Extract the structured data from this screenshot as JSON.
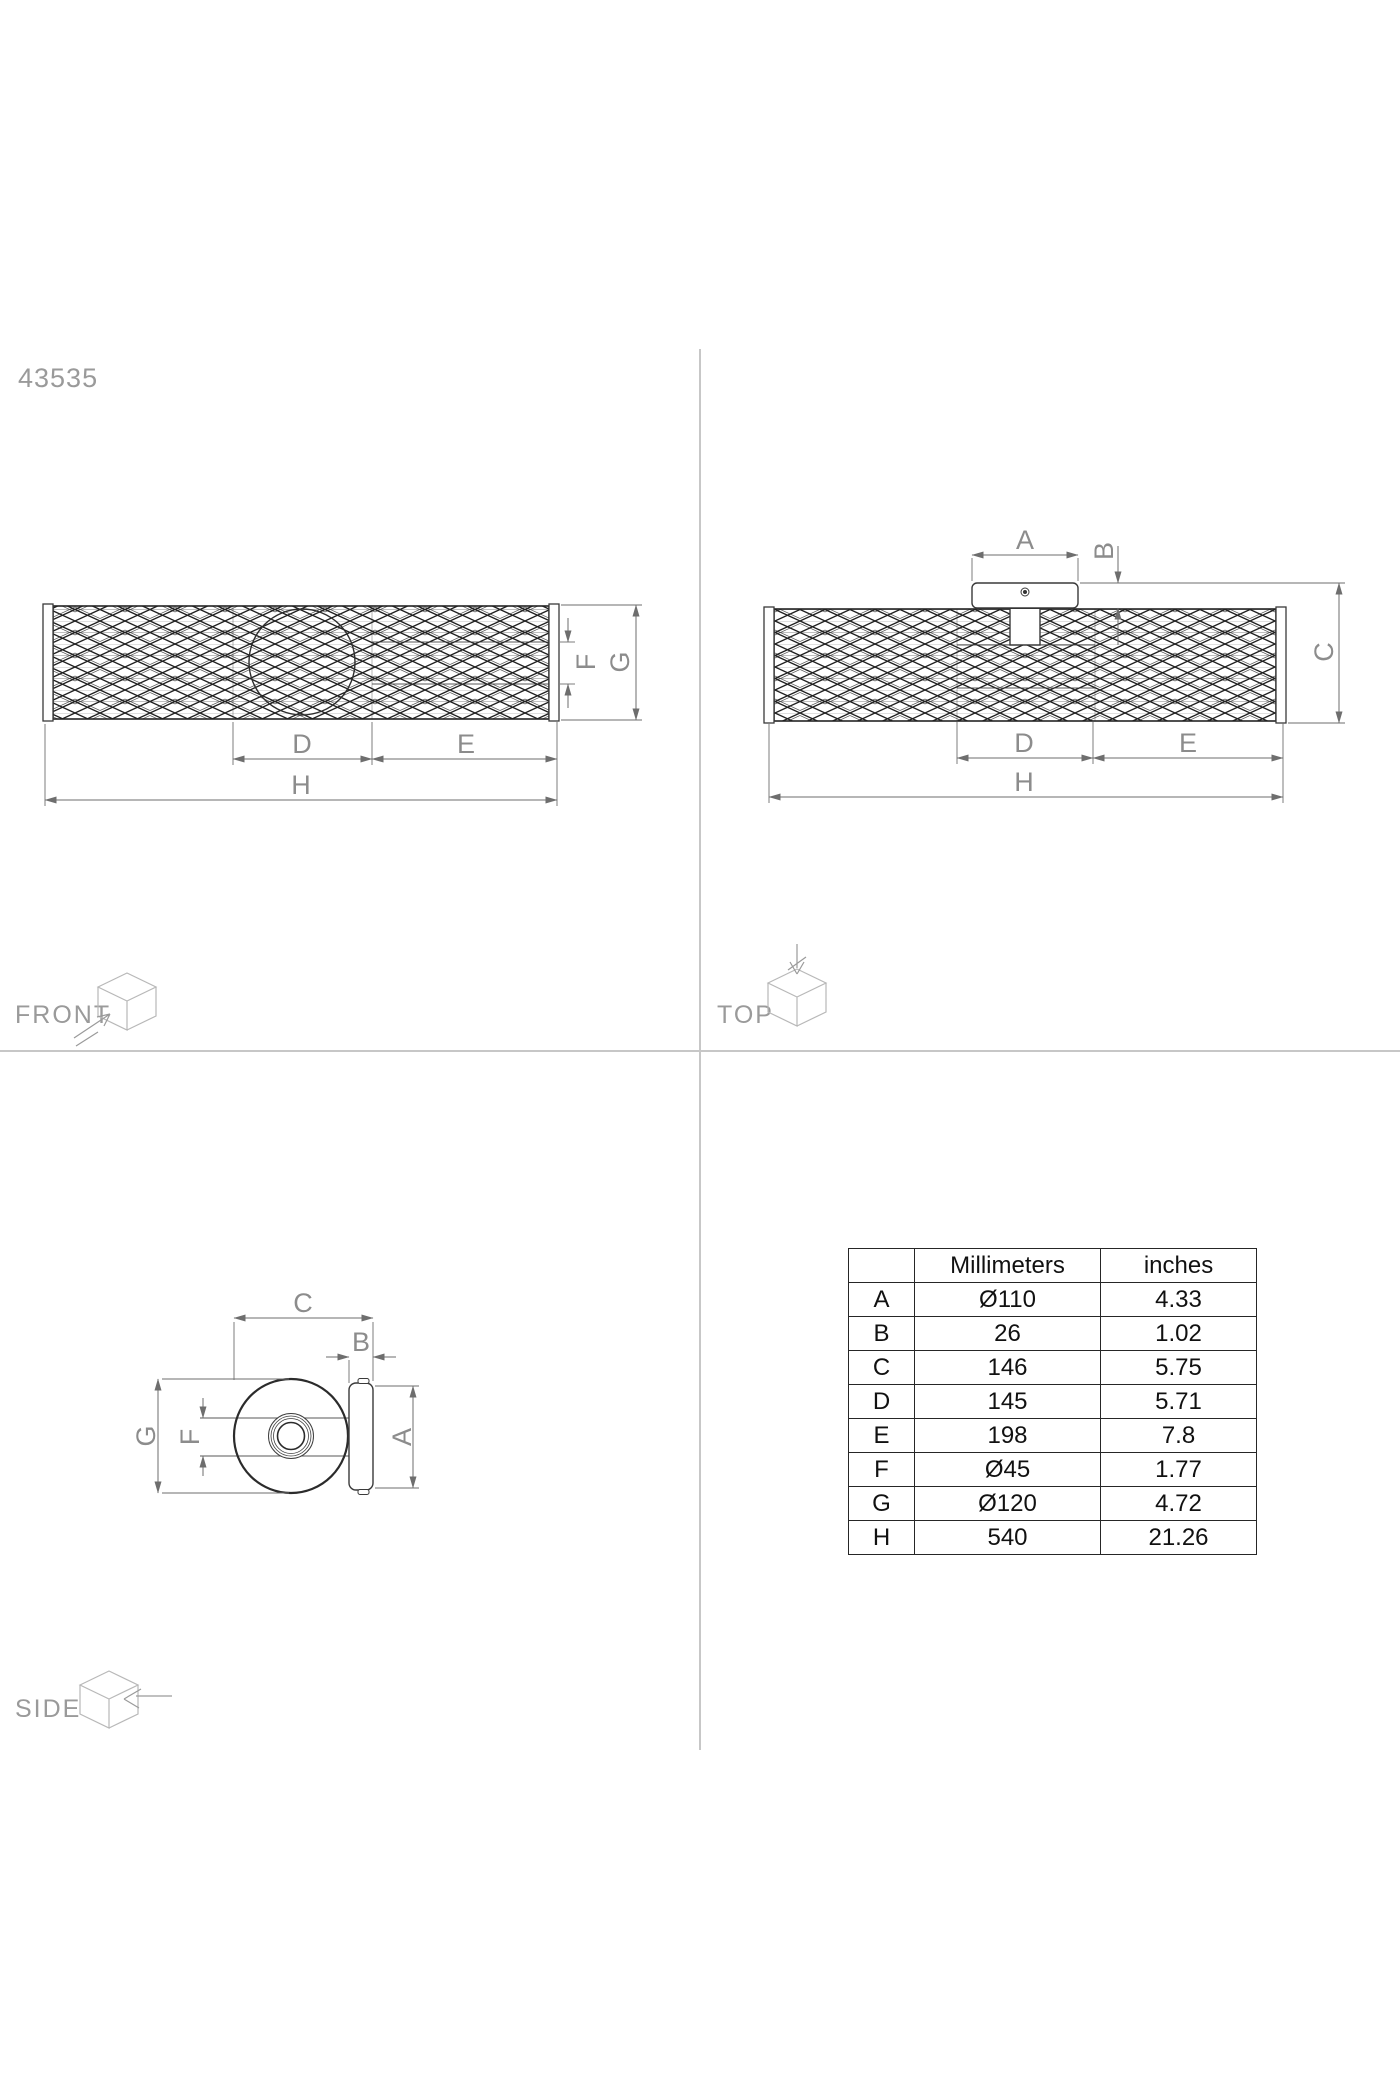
{
  "product_code": "43535",
  "view_labels": {
    "front": "FRONT",
    "top": "TOP",
    "side": "SIDE"
  },
  "dims": {
    "A": "A",
    "B": "B",
    "C": "C",
    "D": "D",
    "E": "E",
    "F": "F",
    "G": "G",
    "H": "H"
  },
  "table": {
    "headers": {
      "key": "",
      "mm": "Millimeters",
      "in": "inches"
    },
    "rows": [
      {
        "key": "A",
        "mm": "Ø110",
        "in": "4.33"
      },
      {
        "key": "B",
        "mm": "26",
        "in": "1.02"
      },
      {
        "key": "C",
        "mm": "146",
        "in": "5.75"
      },
      {
        "key": "D",
        "mm": "145",
        "in": "5.71"
      },
      {
        "key": "E",
        "mm": "198",
        "in": "7.8"
      },
      {
        "key": "F",
        "mm": "Ø45",
        "in": "1.77"
      },
      {
        "key": "G",
        "mm": "Ø120",
        "in": "4.72"
      },
      {
        "key": "H",
        "mm": "540",
        "in": "21.26"
      }
    ]
  },
  "colors": {
    "part_line": "#3a3a3a",
    "dimension_line": "#6e6e6e",
    "label_gray": "#9a9a9a",
    "divider_gray": "#c7c7c7",
    "table_line": "#262626"
  }
}
